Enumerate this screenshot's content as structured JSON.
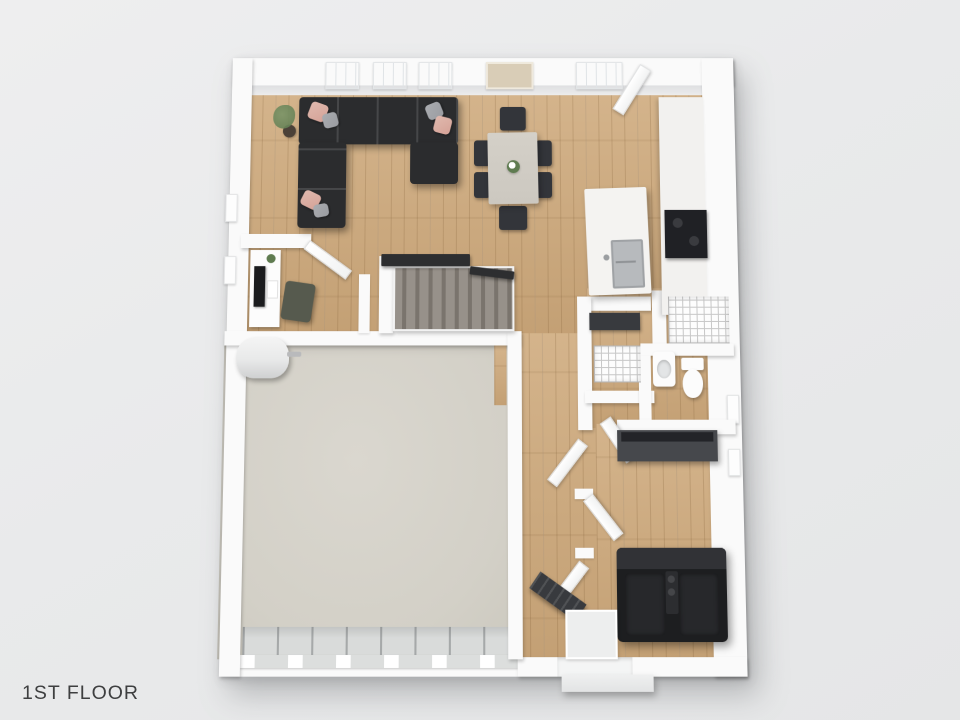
{
  "meta": {
    "title_label": "1ST FLOOR",
    "view": "3d-top-down-floor-plan"
  },
  "features": [
    "sectional-sofa",
    "throw-pillows",
    "corner-plant",
    "dining-table",
    "dining-chairs",
    "flower-centerpiece",
    "kitchen-island",
    "island-sink",
    "range-stove",
    "kitchen-counter",
    "pantry-shelving",
    "coat-closet-shelving",
    "mudroom-bench",
    "bathroom-sink",
    "toilet",
    "staircase",
    "stair-railing",
    "office-desk",
    "desk-monitor",
    "office-chair",
    "water-heater",
    "garage-floor",
    "garage-door-apron",
    "entry-bench",
    "entry-mat",
    "front-step",
    "tv-console",
    "reclining-leather-sofa",
    "windows",
    "open-doors"
  ],
  "colors": {
    "page_bg": "#e9eaeb",
    "page_bg_light": "#eeeeef",
    "wall": "#fafafa",
    "wall_shade": "#dfe0e2",
    "wood": "#cfab7e",
    "concrete": "#d3d0c7",
    "concrete_light": "#dad7cf",
    "apron": "#d9dbda",
    "sofa_dark": "#2b2c2e",
    "pillow_pink": "#e0b9ae",
    "pillow_pink_deep": "#d5a297",
    "pillow_gray": "#9a9ca1",
    "dining_table": "#ccc8c0",
    "chair_dark": "#33353a",
    "counter_white": "#f2f1ef",
    "island_white": "#f4f3f1",
    "sink_gray": "#b7babd",
    "stove_black": "#202125",
    "stair_carpet": "#97918a",
    "stair_riser": "#7a746d",
    "railing_dark": "#2d2e30",
    "shelf_line": "#c8c8c8",
    "fixture_white": "#fcfcfc",
    "tv_console_gray": "#46484c",
    "tv_black": "#232428",
    "leather_black": "#1d1e20",
    "leather_high": "#313236",
    "bench_dark": "#383a3e",
    "entry_mat": "#edeeee",
    "heater_white": "#e8e9e9",
    "plant_green": "#5f7b50",
    "pot_brown": "#4b4138",
    "art_beige": "#d9cdb7",
    "window_glass": "#f3f6f8",
    "label_text": "#3e3f40"
  }
}
